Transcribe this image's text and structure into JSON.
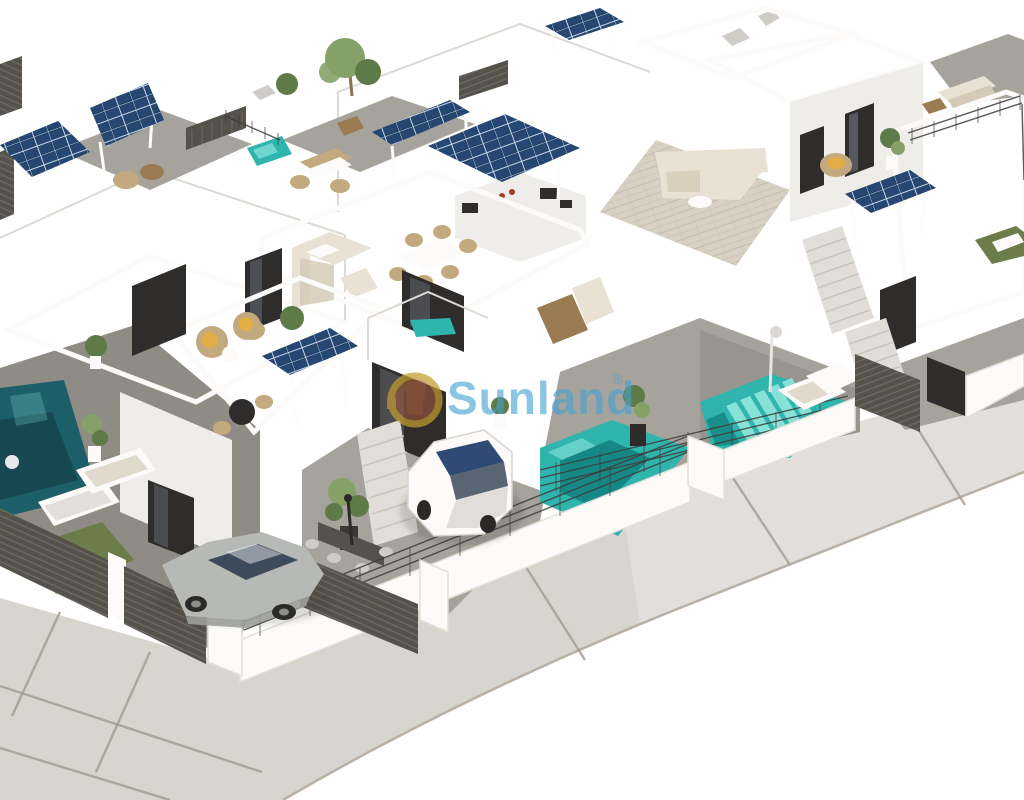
{
  "image": {
    "type": "3d-architectural-aerial-render",
    "description": "Aerial isometric 3D render of a modern white villa development with rooftop solar pergolas, tiled roof terraces, outdoor lounges, private turquoise pools, parked cars, dark slatted fences and a curved corner street. Large semi-transparent Sunland watermark across the middle.",
    "width_px": 1024,
    "height_px": 800,
    "background": "#ffffff"
  },
  "watermark": {
    "text": "Sunland",
    "registered_mark": "®",
    "text_color": "#43a3d4",
    "logo_ring_color": "#c49b2e",
    "logo_core_color": "#9b563f"
  },
  "palette": {
    "bg": "#ffffff",
    "road": "#d8d4ce",
    "roadHi": "#e8e5e0",
    "seam": "#a39a8d",
    "curb": "#b3aa9e",
    "gravel": "#a6a29c",
    "gravelD": "#8f8b85",
    "tile": "#d7d0c3",
    "tileLine": "#c5bdaf",
    "terrace": "#cfc8bb",
    "white1": "#fcfbfa",
    "shade1": "#efedea",
    "shade2": "#e1ded9",
    "shade3": "#cfccc7",
    "outline": "#dddad5",
    "glass": "#2e2d2b",
    "glassHi": "#7d8896",
    "solar": "#1e3e64",
    "solarHi": "#30588a",
    "solarLine": "#c8d6e6",
    "poolDark": "#1c5f68",
    "poolShade": "#0f7d7c",
    "pool": "#2fb4ae",
    "poolHi": "#8ce4da",
    "grass": "#6d7d49",
    "plant": "#5d7a47",
    "plantHi": "#85a168",
    "wicker": "#c2a97e",
    "cushion": "#e2ae45",
    "cream": "#e9e1d3",
    "creamSh": "#d5cab7",
    "brown": "#9b7c52",
    "fence": "#55514b",
    "fenceLine": "#6e6a63",
    "railing": "#3e3c39",
    "silver": "#b6b9b5",
    "silverSh": "#9da09c",
    "carGlass": "#3c4a5a",
    "wmBlue": "#43a3d4",
    "logoGold": "#c49b2e",
    "logoCore": "#9b563f"
  },
  "scene": {
    "objects": [
      {
        "name": "villas",
        "count": 6,
        "style": "white modern flat-roof"
      },
      {
        "name": "solar-panel-pergolas",
        "count": 6,
        "color": "#1e3e64"
      },
      {
        "name": "roof-terraces",
        "finish": "beige tile"
      },
      {
        "name": "private-pools",
        "count": 4,
        "colors": [
          "#1c5f68",
          "#2fb4ae"
        ]
      },
      {
        "name": "in-pool-loungers",
        "count": 5,
        "color": "#8ce4da"
      },
      {
        "name": "corner-sofas",
        "count": 2,
        "color": "#e9e1d3"
      },
      {
        "name": "outdoor-dining-sets",
        "count": 3
      },
      {
        "name": "wicker-chairs-yellow-cushions",
        "count": 3
      },
      {
        "name": "sun-loungers",
        "count": 6
      },
      {
        "name": "white-hatchback-car",
        "position": "center driveway"
      },
      {
        "name": "silver-sedan-car",
        "position": "bottom-left driveway"
      },
      {
        "name": "dark-slatted-fences-and-gates"
      },
      {
        "name": "glass-railings"
      },
      {
        "name": "potted-plants-and-trees"
      },
      {
        "name": "curved-corner-street",
        "color": "#d8d4ce"
      }
    ]
  }
}
